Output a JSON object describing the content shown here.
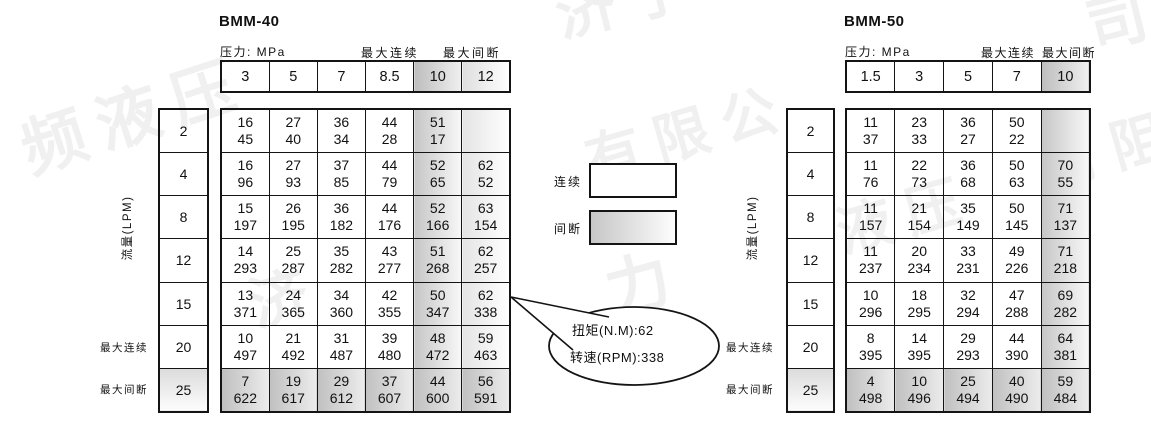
{
  "legend": {
    "continuous_label": "连续",
    "intermittent_label": "间断"
  },
  "callout": {
    "torque_line": "扭矩(N.M):62",
    "speed_line": "转速(RPM):338"
  },
  "watermark": {
    "items": [
      {
        "text": "频液压",
        "x": 8,
        "y": 104,
        "size": 64,
        "rot": -18
      },
      {
        "text": "济宁",
        "x": 545,
        "y": -30,
        "size": 60,
        "rot": -14
      },
      {
        "text": "有限公",
        "x": 575,
        "y": 120,
        "size": 56,
        "rot": -16
      },
      {
        "text": "力",
        "x": 594,
        "y": 244,
        "size": 64,
        "rot": -15
      },
      {
        "text": "济",
        "x": 238,
        "y": 262,
        "size": 58,
        "rot": -16
      },
      {
        "text": "液压",
        "x": 826,
        "y": 192,
        "size": 56,
        "rot": -16
      },
      {
        "text": "有阻",
        "x": 1032,
        "y": 126,
        "size": 56,
        "rot": -16
      },
      {
        "text": "司",
        "x": 1076,
        "y": -18,
        "size": 60,
        "rot": -14
      }
    ]
  },
  "tables": [
    {
      "title": "BMM-40",
      "pressure_caption": "压力: MPa",
      "max_continuous_caption": "最大连续",
      "max_intermittent_caption": "最大间断",
      "flow_axis_label": "流量(LPM)",
      "row_label_max_continuous": "最大连续",
      "row_label_max_intermittent": "最大间断",
      "pressures": [
        "3",
        "5",
        "7",
        "8.5",
        "10",
        "12"
      ],
      "pressure_shades": [
        "",
        "",
        "",
        "",
        "dark",
        "light"
      ],
      "rows": [
        {
          "flow": "2",
          "shaded": false,
          "values": [
            [
              "16",
              "45"
            ],
            [
              "27",
              "40"
            ],
            [
              "36",
              "34"
            ],
            [
              "44",
              "28"
            ],
            [
              "51",
              "17"
            ],
            null
          ]
        },
        {
          "flow": "4",
          "shaded": false,
          "values": [
            [
              "16",
              "96"
            ],
            [
              "27",
              "93"
            ],
            [
              "37",
              "85"
            ],
            [
              "44",
              "79"
            ],
            [
              "52",
              "65"
            ],
            [
              "62",
              "52"
            ]
          ]
        },
        {
          "flow": "8",
          "shaded": false,
          "values": [
            [
              "15",
              "197"
            ],
            [
              "26",
              "195"
            ],
            [
              "36",
              "182"
            ],
            [
              "44",
              "176"
            ],
            [
              "52",
              "166"
            ],
            [
              "63",
              "154"
            ]
          ]
        },
        {
          "flow": "12",
          "shaded": false,
          "values": [
            [
              "14",
              "293"
            ],
            [
              "25",
              "287"
            ],
            [
              "35",
              "282"
            ],
            [
              "43",
              "277"
            ],
            [
              "51",
              "268"
            ],
            [
              "62",
              "257"
            ]
          ]
        },
        {
          "flow": "15",
          "shaded": false,
          "values": [
            [
              "13",
              "371"
            ],
            [
              "24",
              "365"
            ],
            [
              "34",
              "360"
            ],
            [
              "42",
              "355"
            ],
            [
              "50",
              "347"
            ],
            [
              "62",
              "338"
            ]
          ]
        },
        {
          "flow": "20",
          "shaded": false,
          "values": [
            [
              "10",
              "497"
            ],
            [
              "21",
              "492"
            ],
            [
              "31",
              "487"
            ],
            [
              "39",
              "480"
            ],
            [
              "48",
              "472"
            ],
            [
              "59",
              "463"
            ]
          ]
        },
        {
          "flow": "25",
          "shaded": true,
          "values": [
            [
              "7",
              "622"
            ],
            [
              "19",
              "617"
            ],
            [
              "29",
              "612"
            ],
            [
              "37",
              "607"
            ],
            [
              "44",
              "600"
            ],
            [
              "56",
              "591"
            ]
          ]
        }
      ]
    },
    {
      "title": "BMM-50",
      "pressure_caption": "压力: MPa",
      "max_continuous_caption": "最大连续",
      "max_intermittent_caption": "最大间断",
      "flow_axis_label": "流量(LPM)",
      "row_label_max_continuous": "最大连续",
      "row_label_max_intermittent": "最大间断",
      "pressures": [
        "1.5",
        "3",
        "5",
        "7",
        "10"
      ],
      "pressure_shades": [
        "",
        "",
        "",
        "",
        "dark"
      ],
      "rows": [
        {
          "flow": "2",
          "shaded": false,
          "values": [
            [
              "11",
              "37"
            ],
            [
              "23",
              "33"
            ],
            [
              "36",
              "27"
            ],
            [
              "50",
              "22"
            ],
            null
          ]
        },
        {
          "flow": "4",
          "shaded": false,
          "values": [
            [
              "11",
              "76"
            ],
            [
              "22",
              "73"
            ],
            [
              "36",
              "68"
            ],
            [
              "50",
              "63"
            ],
            [
              "70",
              "55"
            ]
          ]
        },
        {
          "flow": "8",
          "shaded": false,
          "values": [
            [
              "11",
              "157"
            ],
            [
              "21",
              "154"
            ],
            [
              "35",
              "149"
            ],
            [
              "50",
              "145"
            ],
            [
              "71",
              "137"
            ]
          ]
        },
        {
          "flow": "12",
          "shaded": false,
          "values": [
            [
              "11",
              "237"
            ],
            [
              "20",
              "234"
            ],
            [
              "33",
              "231"
            ],
            [
              "49",
              "226"
            ],
            [
              "71",
              "218"
            ]
          ]
        },
        {
          "flow": "15",
          "shaded": false,
          "values": [
            [
              "10",
              "296"
            ],
            [
              "18",
              "295"
            ],
            [
              "32",
              "294"
            ],
            [
              "47",
              "288"
            ],
            [
              "69",
              "282"
            ]
          ]
        },
        {
          "flow": "20",
          "shaded": false,
          "values": [
            [
              "8",
              "395"
            ],
            [
              "14",
              "395"
            ],
            [
              "29",
              "293"
            ],
            [
              "44",
              "390"
            ],
            [
              "64",
              "381"
            ]
          ]
        },
        {
          "flow": "25",
          "shaded": true,
          "values": [
            [
              "4",
              "498"
            ],
            [
              "10",
              "496"
            ],
            [
              "25",
              "494"
            ],
            [
              "40",
              "490"
            ],
            [
              "59",
              "484"
            ]
          ]
        }
      ]
    }
  ]
}
